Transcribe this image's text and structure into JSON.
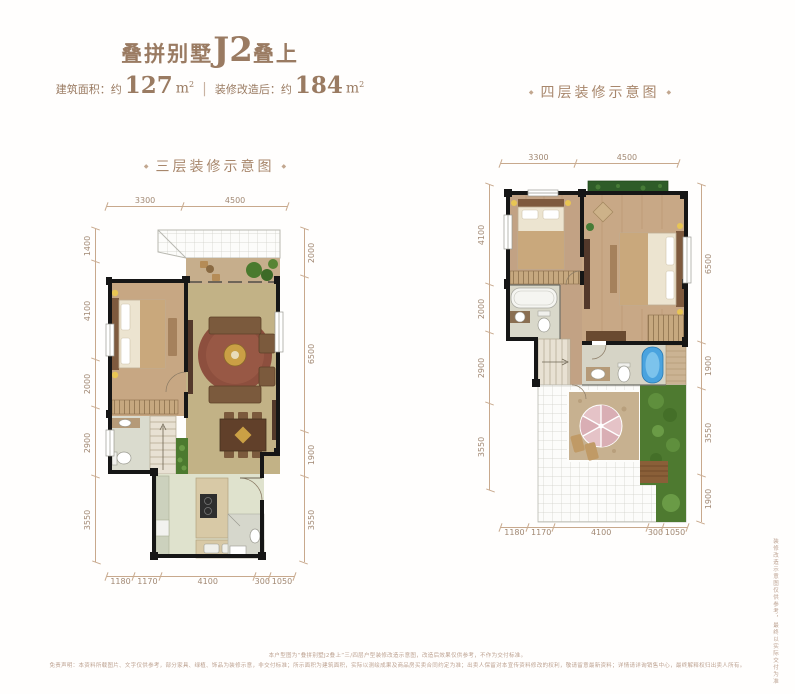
{
  "header": {
    "title": {
      "prefix": "叠拼别墅",
      "model": "J2",
      "suffix": "叠上"
    },
    "subtitle": {
      "area_label": "建筑面积：约",
      "area_value": "127",
      "area_unit": "m",
      "area_sup": "2",
      "divider": "|",
      "reno_label": "装修改造后：约",
      "reno_value": "184",
      "reno_unit": "m",
      "reno_sup": "2"
    }
  },
  "plans": {
    "third": {
      "label": "三层装修示意图",
      "deco": "◆",
      "dims_top": [
        "3300",
        "4500"
      ],
      "dims_left": [
        "1400",
        "4100",
        "2000",
        "2900",
        "3550"
      ],
      "dims_right": [
        "2000",
        "6500",
        "1900",
        "3550"
      ],
      "dims_bottom": [
        "1180",
        "1170",
        "4100",
        "300",
        "1050"
      ]
    },
    "fourth": {
      "label": "四层装修示意图",
      "deco": "◆",
      "dims_top": [
        "3300",
        "4500"
      ],
      "dims_left": [
        "4100",
        "2000",
        "2900",
        "3550"
      ],
      "dims_right": [
        "6500",
        "1900",
        "3550",
        "1900"
      ],
      "dims_bottom": [
        "1180",
        "1170",
        "4100",
        "300",
        "1050"
      ]
    }
  },
  "footer": {
    "line1": "本户型图为“叠拼别墅J2叠上”三/四层户型装修改造示意图，改造后效果仅供参考，不作为交付标准。",
    "line2": "免责声明：本资料所载图片、文字仅供参考，部分家具、绿植、饰品为装修示意，非交付标准；所示面积为建筑面积，实际以测绘成果及商品房买卖合同约定为准；出卖人保留对本宣传资料修改的权利，敬请留意最新资料；详情请详询销售中心，最终解释权归出卖人所有。",
    "side_note": "装修改造示意图仅供参考，最终以实际交付为准"
  }
}
